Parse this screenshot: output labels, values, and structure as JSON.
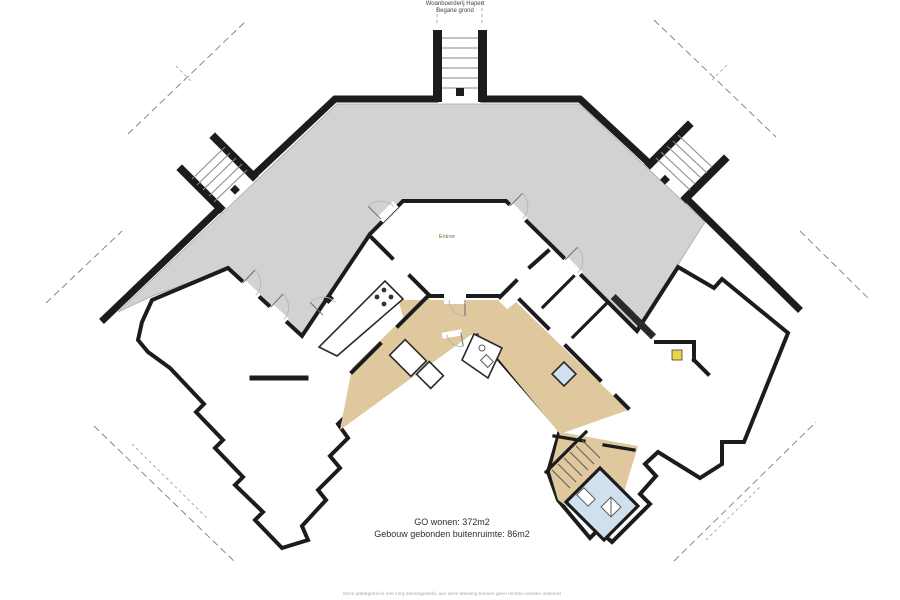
{
  "title": {
    "line1": "Woonboerderij Hapert",
    "line2": "Begane grond"
  },
  "plan": {
    "entree_label": "Entree"
  },
  "summary": {
    "line1": "GO wonen: 372m2",
    "line2": "Gebouw gebonden buitenruimte: 86m2"
  },
  "footer": {
    "disclaimer": "Deze plattegrond is met zorg samengesteld, aan deze tekening kunnen geen rechten worden ontleend"
  },
  "colors": {
    "room_fill": "#eeb566",
    "hall_fill": "#dfc79e",
    "terrace_fill": "#d2d2d2",
    "bathroom_fill": "#cfe0ee",
    "accent_yellow": "#e8d44d",
    "wall": "#1c1c1c"
  }
}
